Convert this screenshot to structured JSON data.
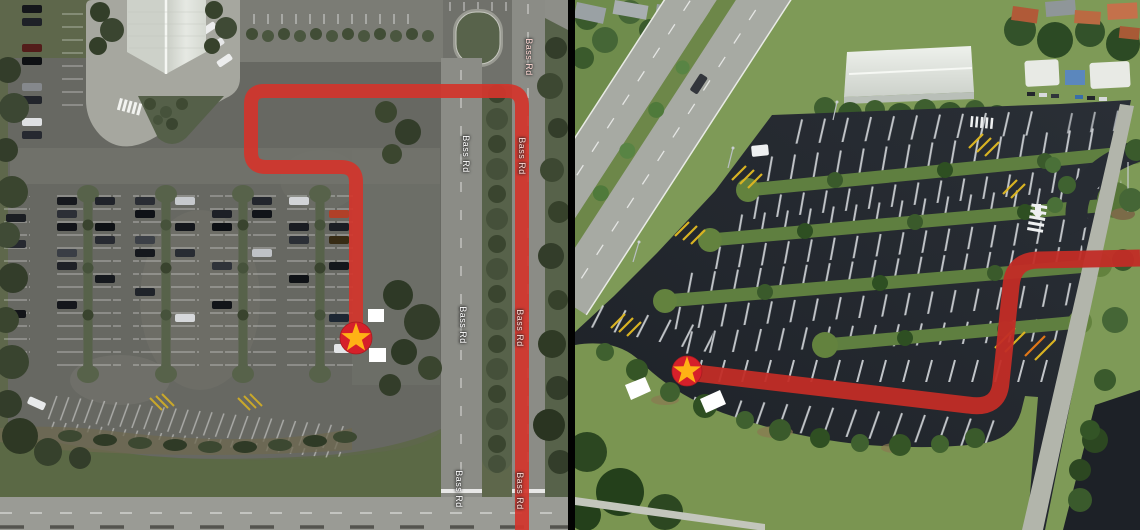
{
  "window": {
    "width": 1140,
    "height": 530
  },
  "palette": {
    "route_red_map": "#d2352c",
    "route_red_photo": "#c22c26",
    "marker_circle": "#d6202a",
    "marker_star": "#ffb215",
    "spot_marker_white": "#ffffff",
    "divider_black": "#020202"
  },
  "left_panel": {
    "kind": "satellite-map",
    "road_name": "Bass Rd",
    "road_labels": [
      {
        "text": "Bass Rd",
        "over_route": true
      },
      {
        "text": "Bass Rd",
        "over_route": false
      },
      {
        "text": "Bass Rd",
        "over_route": true
      },
      {
        "text": "Bass Rd",
        "over_route": false
      },
      {
        "text": "Bass Rd",
        "over_route": true
      },
      {
        "text": "Bass Rd",
        "over_route": false
      },
      {
        "text": "Bass Rd",
        "over_route": true
      }
    ],
    "route": {
      "path": "M 356 338 L 356 182 Q 356 167 341 167 L 266 167 Q 251 167 251 152 L 251 104 Q 251 91 264 91 L 507 91 Q 522 91 522 106 L 522 530",
      "color": "#d2352c",
      "width": 14
    },
    "star_marker": {
      "transform": "translate(356,338)",
      "radius": 16
    },
    "spot_markers": [
      {
        "x": 368,
        "y": 309,
        "w": 16,
        "h": 13
      },
      {
        "x": 369,
        "y": 348,
        "w": 17,
        "h": 14
      }
    ]
  },
  "right_panel": {
    "kind": "aerial-photo",
    "route": {
      "path": "M 112 372 L 393 405 Q 424 410 426 382 L 436 286 Q 438 260 464 260 L 565 258",
      "color": "#c22c26",
      "width": 17
    },
    "star_marker": {
      "transform": "translate(112,371)",
      "radius": 15
    },
    "spot_markers": [
      {
        "points": "50,385 70,377 76,391 56,400"
      },
      {
        "points": "125,399 145,390 151,404 131,413"
      }
    ]
  }
}
